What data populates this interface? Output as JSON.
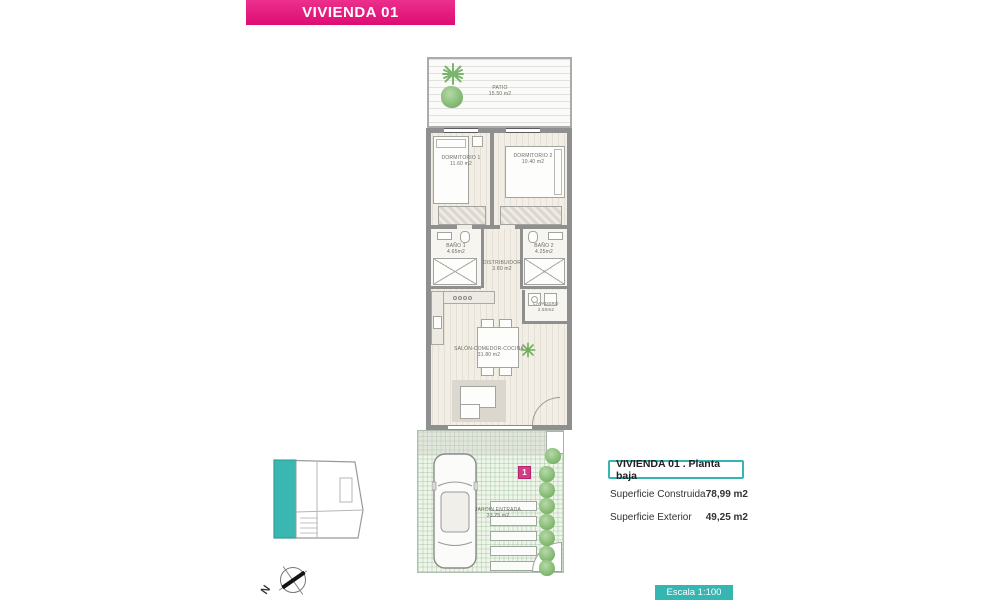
{
  "banner": {
    "title": "VIVIENDA 01"
  },
  "plan": {
    "rooms": {
      "patio": {
        "name": "PATIO",
        "area": "15.50 m2"
      },
      "dormitorio1": {
        "name": "DORMITORIO 1",
        "area": "11.60 m2"
      },
      "dormitorio2": {
        "name": "DORMITORIO 2",
        "area": "10.40 m2"
      },
      "bano1": {
        "name": "BAÑO 1",
        "area": "4.65m2"
      },
      "distribuidor": {
        "name": "DISTRIBUIDOR",
        "area": "3.80 m2"
      },
      "bano2": {
        "name": "BAÑO 2",
        "area": "4.25m2"
      },
      "lavadero": {
        "name": "LAVADERO",
        "area": "2.50m2"
      },
      "salon": {
        "name": "SALÓN-COMEDOR-COCINA",
        "area": "31.80 m2"
      },
      "jardin": {
        "name": "JARDIN ENTRADA",
        "area": "33.75 m2"
      }
    },
    "unit_marker": "1",
    "compass_north": "N"
  },
  "legend": {
    "title": "VIVIENDA 01 .  Planta baja",
    "rows": [
      {
        "label": "Superficie Construida",
        "value": "78,99 m2"
      },
      {
        "label": "Superficie Exterior",
        "value": "49,25 m2"
      }
    ]
  },
  "scale_badge": "Escala 1:100",
  "colors": {
    "accent_pink": "#e5017d",
    "accent_teal": "#35b6b2",
    "wall_gray": "#8f8f8f",
    "plant_green": "#7cb46c",
    "garden_green": "#eef5e9"
  }
}
